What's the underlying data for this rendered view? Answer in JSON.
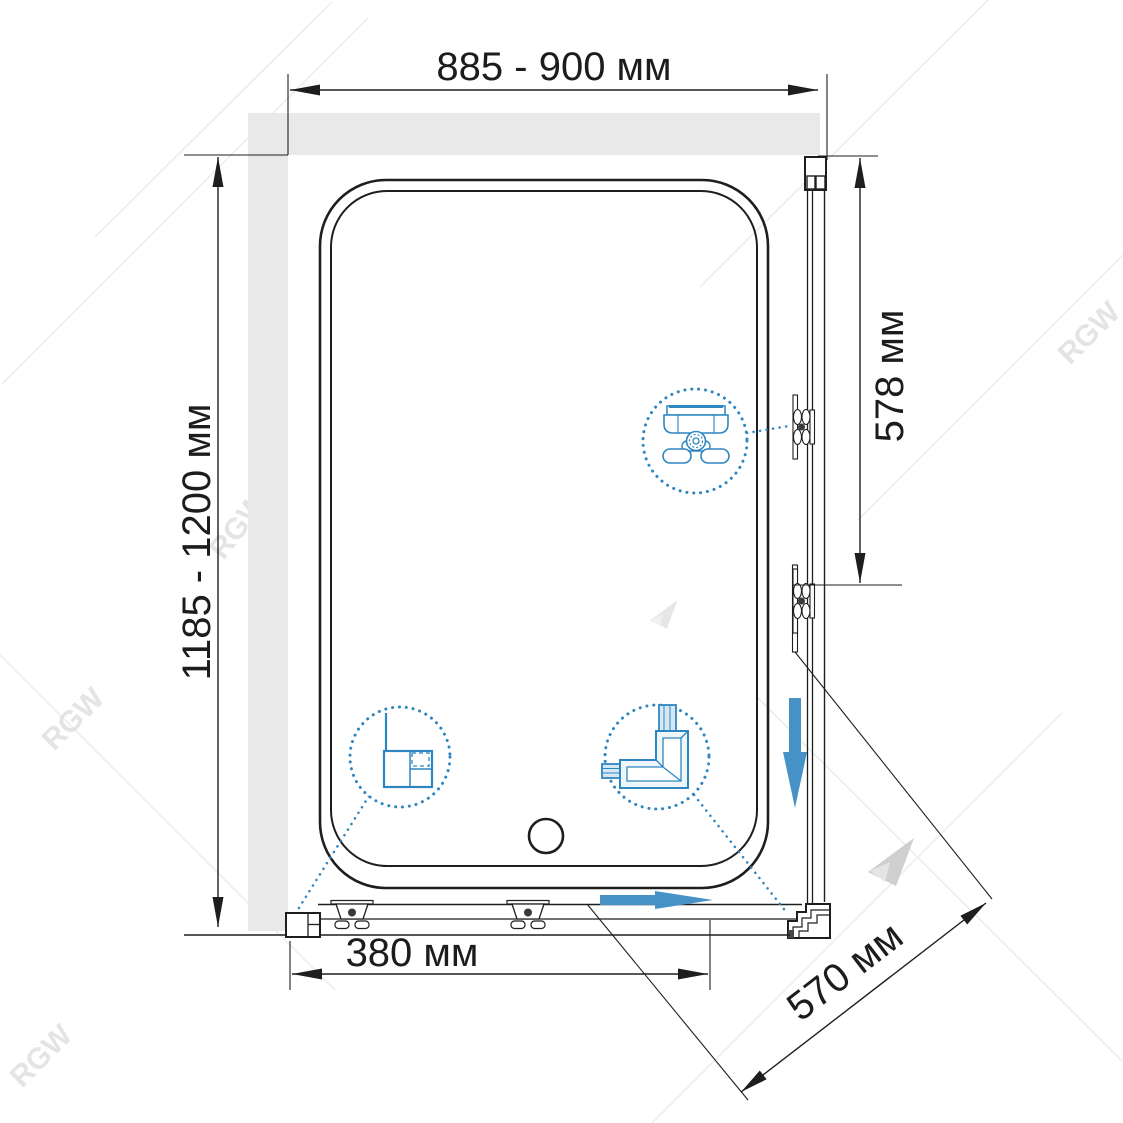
{
  "watermark": {
    "brand": "RGW"
  },
  "dimensions": {
    "width_top": {
      "label": "885 - 900 мм"
    },
    "height_left": {
      "label": "1185 - 1200 мм"
    },
    "side_right": {
      "label": "578 мм"
    },
    "door_bottom": {
      "label": "380 мм"
    },
    "side_diagonal": {
      "label": "570 мм"
    }
  },
  "colors": {
    "line": "#1e1e1e",
    "wall_fill": "#e9e9e9",
    "slide_arrow_blue": "#4691c6",
    "callout_blue": "#2e86c1",
    "watermark_gray": "#dcdcdc"
  },
  "icons": [
    {
      "name": "roller-mechanism-icon",
      "shape": "dotted-circle-callout"
    },
    {
      "name": "wall-profile-section-icon",
      "shape": "dotted-circle-callout"
    },
    {
      "name": "corner-connector-icon",
      "shape": "dotted-circle-callout"
    },
    {
      "name": "slide-direction-down-arrow",
      "shape": "filled-arrow"
    },
    {
      "name": "slide-direction-right-arrow",
      "shape": "filled-arrow"
    }
  ]
}
